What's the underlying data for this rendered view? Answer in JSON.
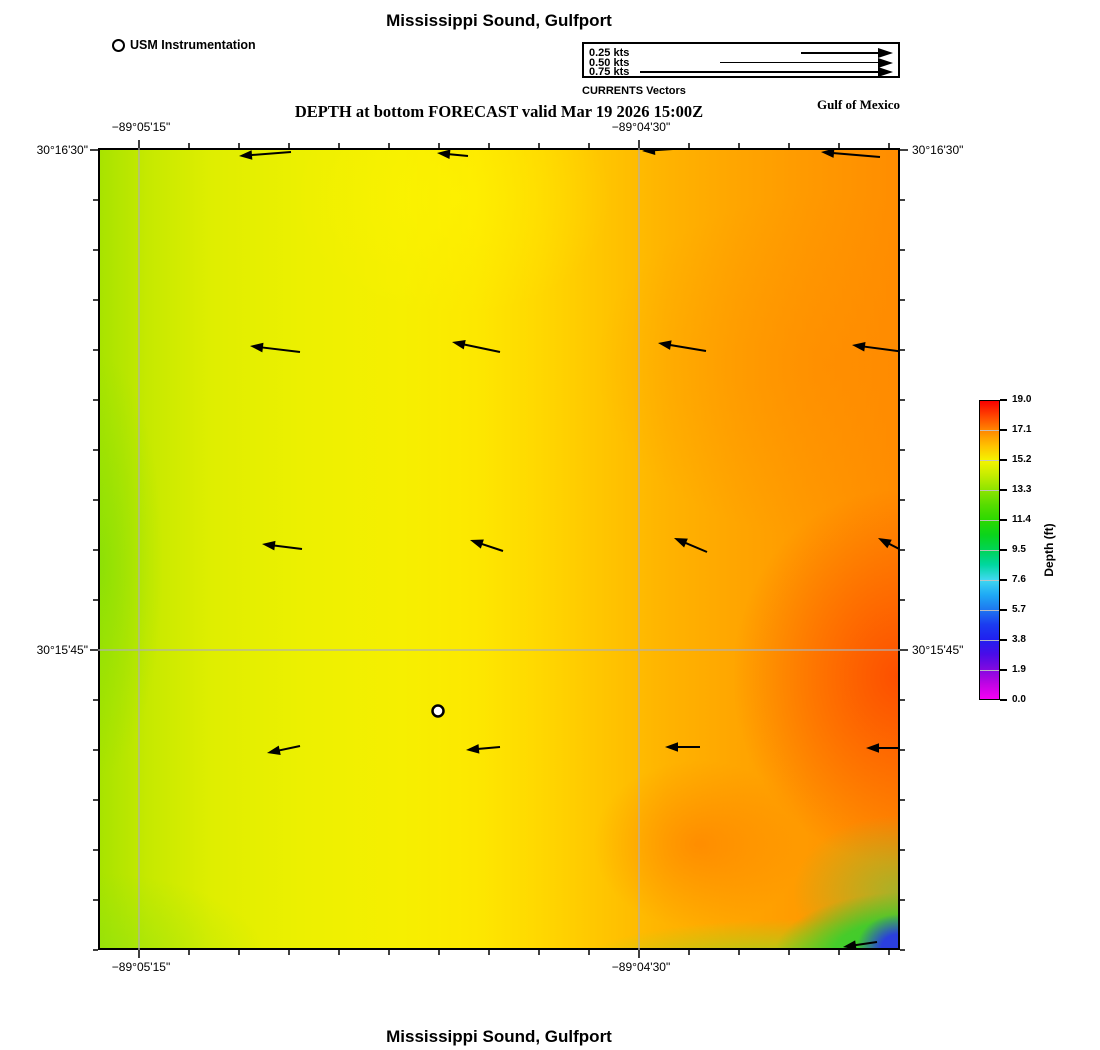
{
  "titles": {
    "top": "Mississippi Sound, Gulfport",
    "subtitle": "DEPTH at bottom FORECAST valid Mar 19 2026 15:00Z",
    "region": "Gulf of Mexico",
    "bottom": "Mississippi Sound, Gulfport"
  },
  "instrumentation": {
    "label": "USM Instrumentation"
  },
  "currents_legend": {
    "caption": "CURRENTS Vectors",
    "arrow_end_px": 895,
    "rows": [
      {
        "label": "0.25 kts",
        "speed_kts": 0.25,
        "arrow_start_px": 803
      },
      {
        "label": "0.50 kts",
        "speed_kts": 0.5,
        "arrow_start_px": 722
      },
      {
        "label": "0.75 kts",
        "speed_kts": 0.75,
        "arrow_start_px": 642
      }
    ]
  },
  "axes": {
    "lon_ticks": [
      {
        "label": "−89°05'15\"",
        "x_px": 139
      },
      {
        "label": "−89°04'30\"",
        "x_px": 639
      }
    ],
    "lat_ticks": [
      {
        "label": "30°16'30\"",
        "y_px": 150
      },
      {
        "label": "30°15'45\"",
        "y_px": 650
      }
    ],
    "minor_tick_spacing_px": 50
  },
  "colorbar": {
    "title": "Depth (ft)",
    "tick_labels": [
      "19.0",
      "17.1",
      "15.2",
      "13.3",
      "11.4",
      "9.5",
      "7.6",
      "5.7",
      "3.8",
      "1.9",
      "0.0"
    ]
  },
  "chart_data": {
    "type": "heatmap",
    "title": "Mississippi Sound, Gulfport",
    "subtitle": "DEPTH at bottom FORECAST valid Mar 19 2026 15:00Z",
    "valid_time": "Mar 19 2026 15:00Z",
    "variable": "Depth (ft)",
    "region_label": "Gulf of Mexico",
    "x_axis": {
      "type": "longitude",
      "tick_labels": [
        "−89°05'15\"",
        "−89°04'30\""
      ]
    },
    "y_axis": {
      "type": "latitude",
      "tick_labels": [
        "30°16'30\"",
        "30°15'45\""
      ]
    },
    "color_scale": {
      "label": "Depth (ft)",
      "ticks": [
        19.0,
        17.1,
        15.2,
        13.3,
        11.4,
        9.5,
        7.6,
        5.7,
        3.8,
        1.9,
        0.0
      ],
      "range": [
        0.0,
        19.0
      ],
      "colors_top_to_bottom": [
        "#f80000",
        "#ff8800",
        "#f4f400",
        "#8ce400",
        "#2bd900",
        "#00d455",
        "#40d8f0",
        "#1e78f0",
        "#2020f0",
        "#8009e0",
        "#f400f4"
      ]
    },
    "field_summary": "Bottom depth about 13-15 ft (yellow-green) in the west, deepening to about 18-19 ft (orange-red) toward the east; shallow 0-8 ft (green to blue) pocket in the far southeast corner",
    "station_marker": {
      "label": "USM Instrumentation",
      "px": [
        438,
        711
      ]
    },
    "current_vector_legend_kts": [
      0.25,
      0.5,
      0.75
    ],
    "vector_arrows_px": [
      [
        239,
        156,
        291,
        152
      ],
      [
        437,
        153,
        468,
        156
      ],
      [
        642,
        151,
        688,
        148
      ],
      [
        821,
        152,
        880,
        157
      ],
      [
        250,
        346,
        300,
        352
      ],
      [
        452,
        342,
        500,
        352
      ],
      [
        658,
        343,
        706,
        351
      ],
      [
        852,
        345,
        905,
        352
      ],
      [
        262,
        544,
        302,
        549
      ],
      [
        470,
        540,
        503,
        551
      ],
      [
        674,
        538,
        707,
        552
      ],
      [
        878,
        538,
        907,
        553
      ],
      [
        267,
        753,
        300,
        746
      ],
      [
        466,
        750,
        500,
        747
      ],
      [
        665,
        747,
        700,
        747
      ],
      [
        866,
        748,
        904,
        748
      ],
      [
        843,
        947,
        877,
        942
      ]
    ],
    "grid_px": {
      "v": [
        139,
        639
      ],
      "h": [
        650
      ]
    },
    "plot_area_px": {
      "left": 98,
      "top": 148,
      "right": 900,
      "bottom": 950
    }
  }
}
